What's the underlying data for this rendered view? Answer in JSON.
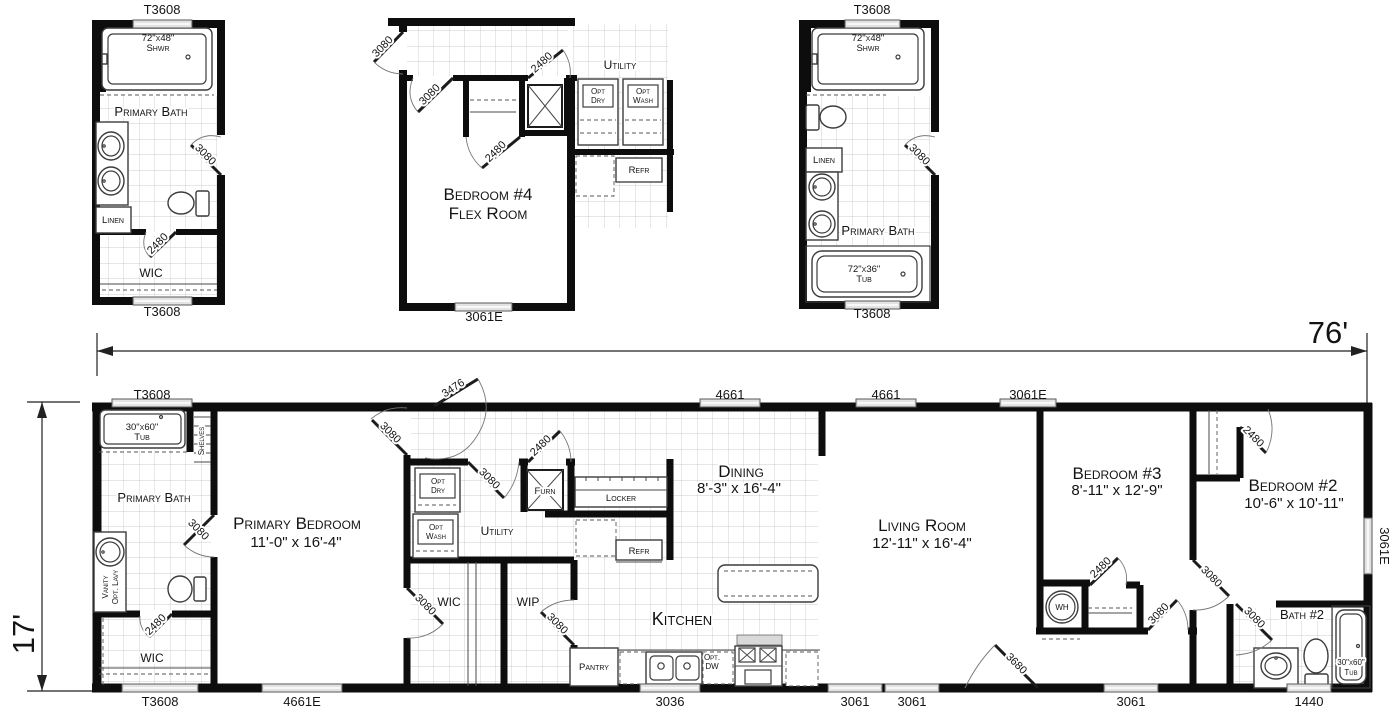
{
  "dims": {
    "width": "76'",
    "height": "17'"
  },
  "a": {
    "win_top": "T3608",
    "win_bottom": "T3608",
    "shower_size": "72\"x48\"",
    "shower": "Shwr",
    "room": "Primary Bath",
    "door_bath": "3080",
    "linen": "Linen",
    "door_wic": "2480",
    "wic": "WIC"
  },
  "b": {
    "door_hall": "3080",
    "door_bedroom": "3080",
    "door_closet": "2480",
    "door_utility": "2480",
    "utility": "Utility",
    "opt": "Opt",
    "dry": "Dry",
    "wash": "Wash",
    "refr": "Refr",
    "room_line1": "Bedroom #4",
    "room_line2": "Flex Room",
    "win_bottom": "3061E"
  },
  "c": {
    "win_top": "T3608",
    "win_bottom": "T3608",
    "shower_size": "72\"x48\"",
    "shower": "Shwr",
    "room": "Primary Bath",
    "door_bath": "3080",
    "linen": "Linen",
    "tub_size": "72\"x36\"",
    "tub": "Tub"
  },
  "m": {
    "win_t3608_top": "T3608",
    "door_front": "3476",
    "win_4661_a": "4661",
    "win_4661_b": "4661",
    "win_3061e_top": "3061E",
    "win_3061e_right": "3061E",
    "win_t3608_bottom": "T3608",
    "win_4661e": "4661E",
    "win_3036": "3036",
    "win_3061_a": "3061",
    "win_3061_b": "3061",
    "door_rear": "3680",
    "win_3061_c": "3061",
    "win_1440": "1440",
    "tub_size": "30\"x60\"",
    "tub": "Tub",
    "shelves": "Shelves",
    "bath": "Primary Bath",
    "door_bath": "3080",
    "vanity_line1": "Vanity",
    "vanity_line2": "Opt. Lavy",
    "door_wic": "2480",
    "wic": "WIC",
    "bedroom1": "Primary Bedroom",
    "bedroom1_size": "11'-0\" x 16'-4\"",
    "door_bedroom1": "3080",
    "utility": "Utility",
    "opt": "Opt",
    "dry": "Dry",
    "wash": "Wash",
    "furn": "Furn",
    "door_furn": "2480",
    "door_utility": "3080",
    "locker": "Locker",
    "refr": "Refr",
    "wic2": "WIC",
    "door_wic2": "3080",
    "wip": "WIP",
    "door_wip": "3080",
    "kitchen": "Kitchen",
    "pantry": "Pantry",
    "opt_dw_line1": "Opt.",
    "opt_dw_line2": "DW",
    "dining": "Dining",
    "dining_size": "8'-3\" x 16'-4\"",
    "living": "Living Room",
    "living_size": "12'-11\" x 16'-4\"",
    "bedroom3": "Bedroom #3",
    "bedroom3_size": "8'-11\" x 12'-9\"",
    "wh": "WH",
    "door_bed3_closet": "2480",
    "door_bedroom3": "3080",
    "bedroom2": "Bedroom #2",
    "bedroom2_size": "10'-6\" x 10'-11\"",
    "door_bed2_closet": "2480",
    "door_bedroom2": "3080",
    "bath2": "Bath #2",
    "door_bath2": "3080",
    "tub2_size": "30\"x60\"",
    "tub2": "Tub"
  }
}
